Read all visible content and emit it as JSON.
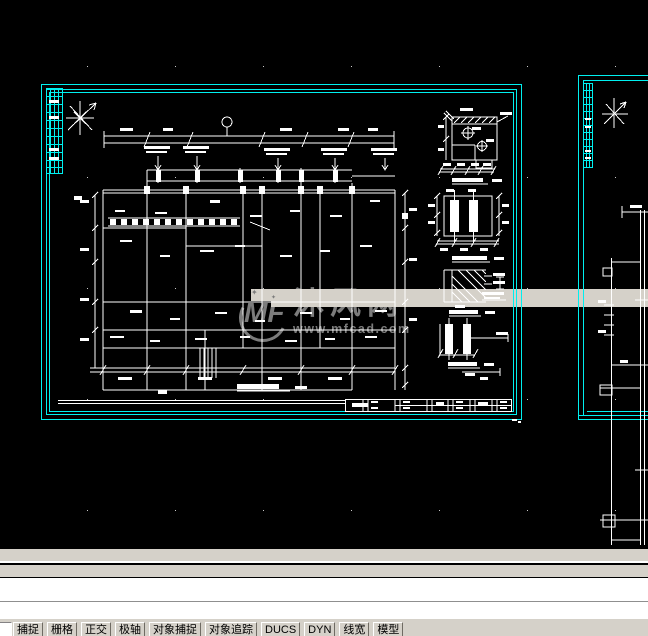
{
  "colors": {
    "background": "#000000",
    "cad_cyan": "#00f0f0",
    "line_white": "#ffffff",
    "watermark_gray": "#7c7c7c",
    "ui_gray": "#d5d1c9"
  },
  "watermark": {
    "logo": "MF",
    "star": "✦",
    "brand": "沐风网",
    "reg_mark": "®",
    "url": "www.mfcad.com"
  },
  "command_window": {
    "line1": "",
    "line2": ""
  },
  "status_bar": {
    "coordinate_field": "",
    "buttons": [
      {
        "name": "snap",
        "label": "捕捉"
      },
      {
        "name": "grid",
        "label": "栅格"
      },
      {
        "name": "ortho",
        "label": "正交"
      },
      {
        "name": "polar",
        "label": "极轴"
      },
      {
        "name": "osnap",
        "label": "对象捕捉"
      },
      {
        "name": "otrack",
        "label": "对象追踪"
      },
      {
        "name": "ducs",
        "label": "DUCS"
      },
      {
        "name": "dyn",
        "label": "DYN"
      },
      {
        "name": "lineweight",
        "label": "线宽"
      },
      {
        "name": "model",
        "label": "模型"
      }
    ]
  }
}
